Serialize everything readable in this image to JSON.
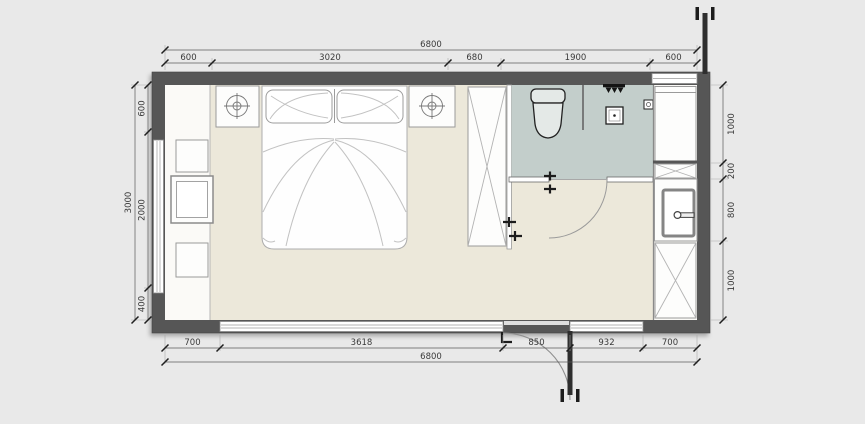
{
  "colors": {
    "background": "#e9e9e9",
    "wall": "#565656",
    "bedroom_floor": "#ece8da",
    "bathroom_floor": "#c3cecb",
    "furniture_fill": "#fdfdfc",
    "furniture_outline": "#9a9a9a",
    "dimension_text": "#3a3a3a"
  },
  "dimensions": {
    "top": {
      "overall": "6800",
      "segments": [
        "600",
        "3020",
        "680",
        "1900",
        "600"
      ]
    },
    "bottom": {
      "overall": "6800",
      "segments": [
        "700",
        "3618",
        "850",
        "932",
        "700"
      ]
    },
    "left": {
      "overall": "3000",
      "segments": [
        "600",
        "2000",
        "400"
      ]
    },
    "right": {
      "segments": [
        "1000",
        "200",
        "800",
        "1000"
      ]
    }
  }
}
